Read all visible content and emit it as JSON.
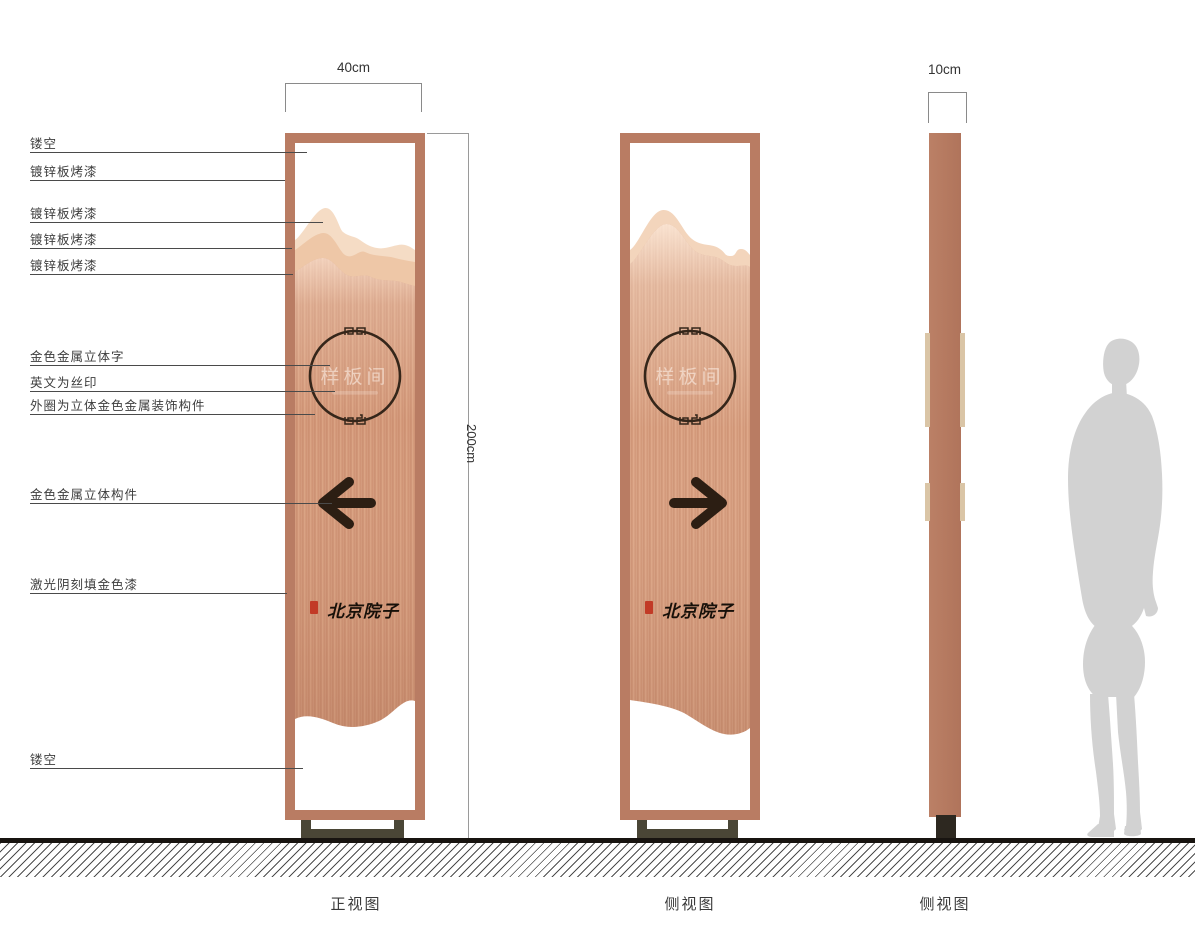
{
  "dimensions": {
    "front_width": "40cm",
    "height": "200cm",
    "side_depth": "10cm"
  },
  "annotations": [
    {
      "label": "镂空",
      "y": 152,
      "x2": 307
    },
    {
      "label": "镀锌板烤漆",
      "y": 180,
      "x2": 285
    },
    {
      "label": "镀锌板烤漆",
      "y": 222,
      "x2": 323
    },
    {
      "label": "镀锌板烤漆",
      "y": 248,
      "x2": 292
    },
    {
      "label": "镀锌板烤漆",
      "y": 274,
      "x2": 293
    },
    {
      "label": "金色金属立体字",
      "y": 365,
      "x2": 330
    },
    {
      "label": "英文为丝印",
      "y": 391,
      "x2": 335
    },
    {
      "label": "外圈为立体金色金属装饰构件",
      "y": 414,
      "x2": 315
    },
    {
      "label": "金色金属立体构件",
      "y": 503,
      "x2": 332
    },
    {
      "label": "激光阴刻填金色漆",
      "y": 593,
      "x2": 287
    },
    {
      "label": "镂空",
      "y": 768,
      "x2": 303
    }
  ],
  "signs": {
    "front": {
      "view_label": "正视图",
      "plaque_text": "样板间",
      "brand_text": "北京院子",
      "arrow_direction": "left"
    },
    "side_back": {
      "view_label": "侧视图",
      "plaque_text": "样板间",
      "brand_text": "北京院子",
      "arrow_direction": "right"
    },
    "side_profile": {
      "view_label": "侧视图"
    }
  },
  "colors": {
    "frame_copper": "#b97c63",
    "panel_copper": "#d49a7c",
    "mountain_light": "#f5dcc5",
    "mountain_mid": "#eec7a7",
    "base_dark": "#4a4636",
    "seal_red": "#c23a26",
    "arrow_dark": "#2c1e13",
    "silhouette_gray": "#d2d2d2"
  }
}
